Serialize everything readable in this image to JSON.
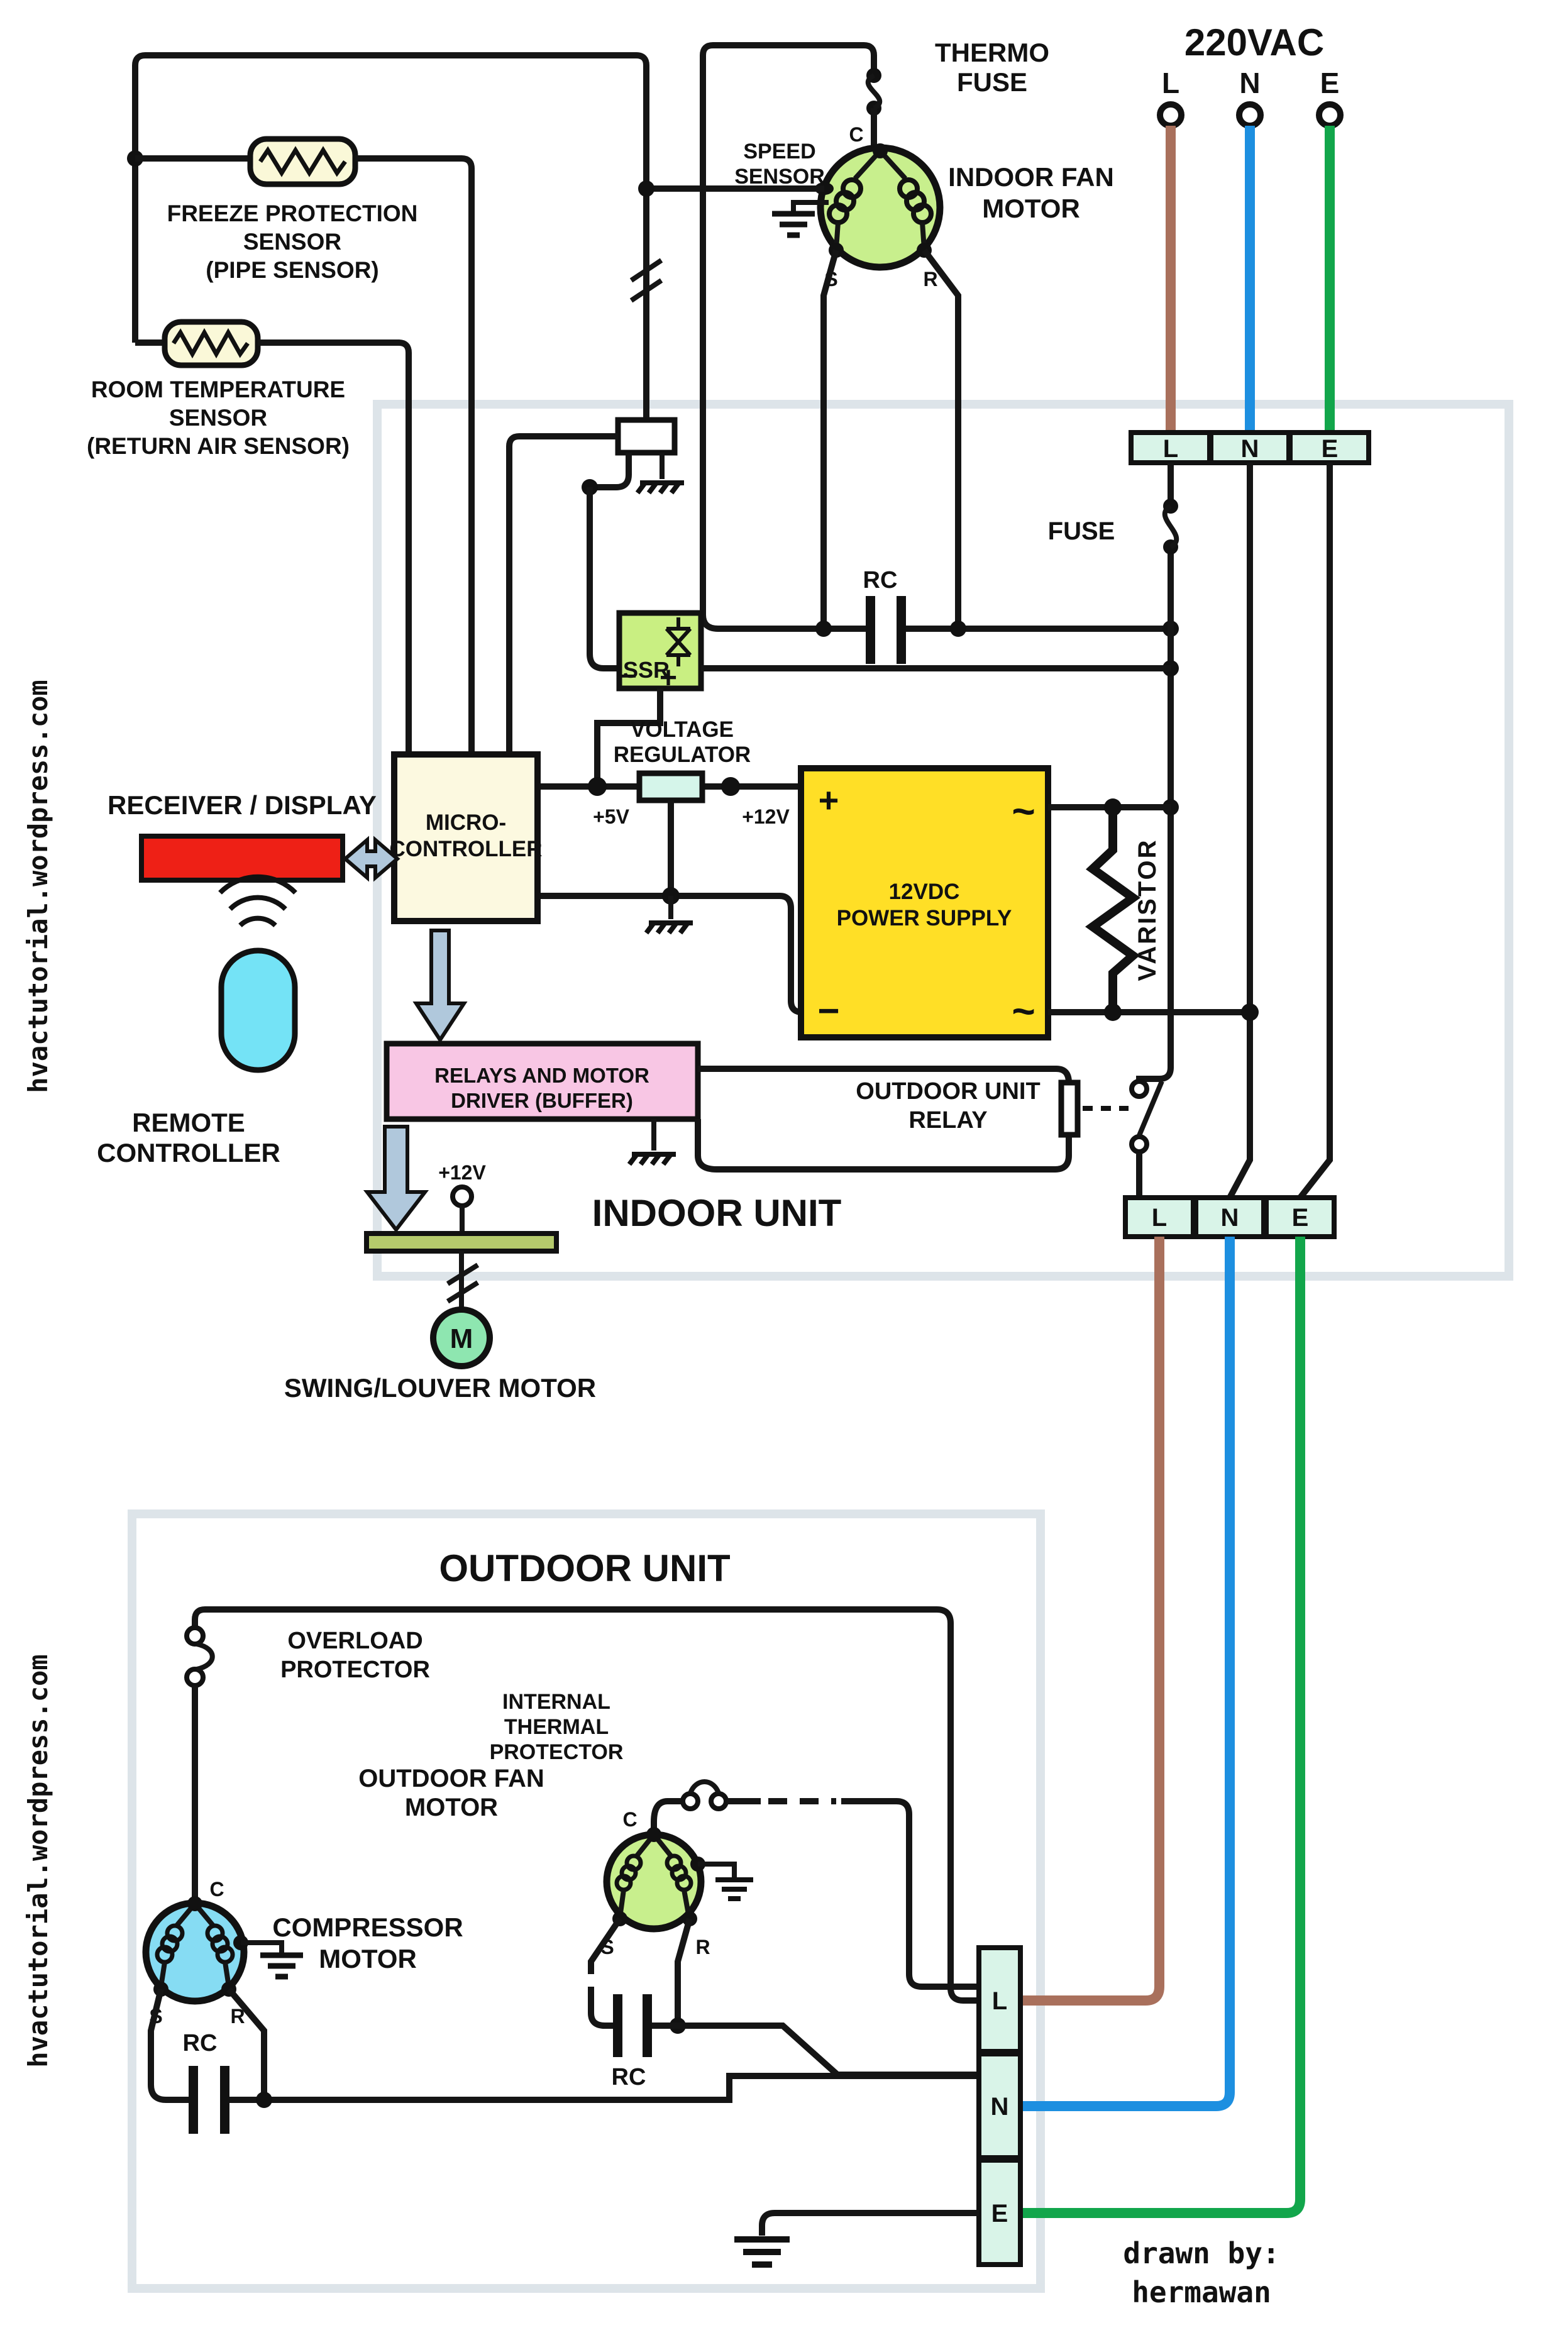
{
  "colors": {
    "wire": "#151515",
    "brown": "#a9705c",
    "blue": "#1d8fe0",
    "green": "#12a64b",
    "mint": "#d9f4e8",
    "motor_green": "#c8ef8d",
    "compressor_blue": "#86dcf3",
    "ssr_green": "#c9ef82",
    "psu_yellow": "#ffdf26",
    "micro_cream": "#fcf9e0",
    "relays_pink": "#f8c6e4",
    "relays_text": "#4a1033",
    "receiver_red": "#ee2016",
    "remote_cyan": "#74e3f6",
    "arrow_blue": "#b0c8dc",
    "olive_bar": "#b5ca6c",
    "sensor_cream": "#faf8d8",
    "unit_box_border": "#dde4e9",
    "regulator_fill": "#d5f5ea",
    "swing_motor_green": "#8ee6b0"
  },
  "source": {
    "title": "220VAC",
    "l": "L",
    "n": "N",
    "e": "E"
  },
  "indoor": {
    "title": "INDOOR UNIT",
    "top_terminal": {
      "l": "L",
      "n": "N",
      "e": "E"
    },
    "bottom_terminal": {
      "l": "L",
      "n": "N",
      "e": "E"
    },
    "thermo_fuse": [
      "THERMO",
      "FUSE"
    ],
    "speed_sensor": [
      "SPEED",
      "SENSOR"
    ],
    "fan_motor": {
      "line1": "INDOOR FAN",
      "line2": "MOTOR",
      "c": "C",
      "s": "S",
      "r": "R"
    },
    "freeze_sensor": [
      "FREEZE PROTECTION",
      "SENSOR",
      "(PIPE SENSOR)"
    ],
    "room_sensor": [
      "ROOM TEMPERATURE",
      "SENSOR",
      "(RETURN AIR SENSOR)"
    ],
    "rc": "RC",
    "fuse": "FUSE",
    "ssr": "SSR",
    "ssr_minus": "−",
    "ssr_plus": "+",
    "voltage_regulator": [
      "VOLTAGE",
      "REGULATOR"
    ],
    "v5": "+5V",
    "v12": "+12V",
    "v12_swing": "+12V",
    "psu": {
      "line1": "12VDC",
      "line2": "POWER SUPPLY",
      "plus": "+",
      "minus": "−",
      "ac_top": "~",
      "ac_bottom": "~"
    },
    "varistor": "VARISTOR",
    "micro": [
      "MICRO-",
      "CONTROLLER"
    ],
    "receiver": "RECEIVER / DISPLAY",
    "remote": [
      "REMOTE",
      "CONTROLLER"
    ],
    "relays": [
      "RELAYS AND MOTOR",
      "DRIVER (BUFFER)"
    ],
    "outdoor_relay": [
      "OUTDOOR UNIT",
      "RELAY"
    ],
    "swing_motor": {
      "m": "M",
      "label": "SWING/LOUVER MOTOR"
    }
  },
  "outdoor": {
    "title": "OUTDOOR UNIT",
    "overload": [
      "OVERLOAD",
      "PROTECTOR"
    ],
    "thermal": [
      "INTERNAL",
      "THERMAL",
      "PROTECTOR"
    ],
    "fan_motor": {
      "line1": "OUTDOOR FAN",
      "line2": "MOTOR",
      "c": "C",
      "s": "S",
      "r": "R"
    },
    "compressor": {
      "line1": "COMPRESSOR",
      "line2": "MOTOR",
      "c": "C",
      "s": "S",
      "r": "R"
    },
    "rc_fan": "RC",
    "rc_comp": "RC",
    "terminal": {
      "l": "L",
      "n": "N",
      "e": "E"
    }
  },
  "watermark": "hvactutorial.wordpress.com",
  "credit": {
    "line1": "drawn by:",
    "line2": "hermawan"
  }
}
